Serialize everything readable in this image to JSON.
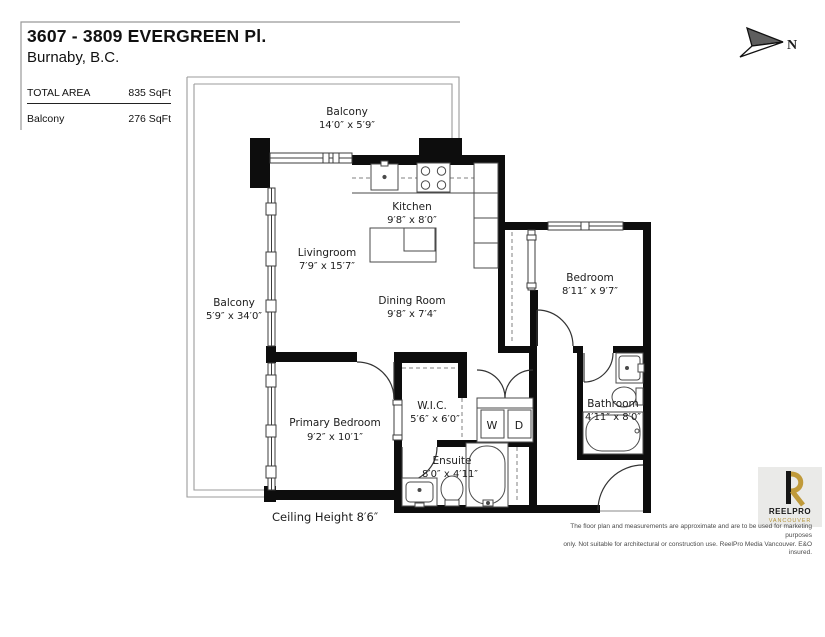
{
  "header": {
    "title": "3607 - 3809 EVERGREEN Pl.",
    "city": "Burnaby, B.C."
  },
  "area_table": {
    "rows": [
      {
        "label": "TOTAL AREA",
        "value": "835 SqFt"
      },
      {
        "label": "Balcony",
        "value": "276 SqFt"
      }
    ]
  },
  "compass": {
    "north_label": "N"
  },
  "rooms": [
    {
      "name": "Balcony",
      "dims": "14′0″ x 5′9″"
    },
    {
      "name": "Balcony",
      "dims": "5′9″ x 34′0″"
    },
    {
      "name": "Kitchen",
      "dims": "9′8″ x 8′0″"
    },
    {
      "name": "Livingroom",
      "dims": "7′9″ x 15′7″"
    },
    {
      "name": "Dining Room",
      "dims": "9′8″ x 7′4″"
    },
    {
      "name": "Bedroom",
      "dims": "8′11″ x 9′7″"
    },
    {
      "name": "Primary Bedroom",
      "dims": "9′2″ x 10′1″"
    },
    {
      "name": "W.I.C.",
      "dims": "5′6″ x 6′0″"
    },
    {
      "name": "Ensuite",
      "dims": "8′0″ x 4′11″"
    },
    {
      "name": "Bathroom",
      "dims": "4′11″ x 8′0″"
    }
  ],
  "laundry": {
    "washer_label": "W",
    "dryer_label": "D"
  },
  "notes": {
    "ceiling": "Ceiling Height  8′6″"
  },
  "logo": {
    "brand": "REELPRO",
    "city": "VANCOUVER"
  },
  "footer": {
    "disclaimer": [
      "The floor plan and measurements are approximate and are to be used for marketing purposes",
      "only. Not suitable for architectural or construction use. ReelPro Media Vancouver. E&O insured."
    ]
  }
}
